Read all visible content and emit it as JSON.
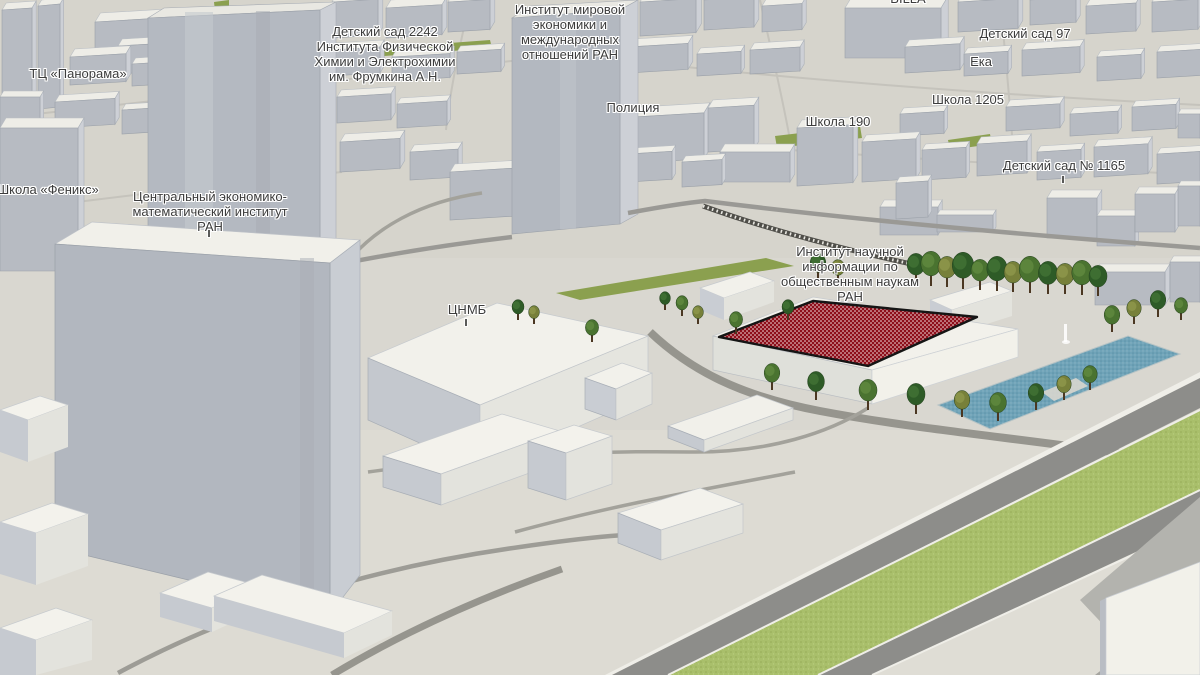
{
  "map": {
    "view": "3d-buildings-perspective",
    "colors": {
      "selection_red": "#8e0e1a",
      "water": "#6fa3b8",
      "grass_median": "#a9bf6b",
      "grass_far": "#8ba04f",
      "label_text": "#3c3c3c"
    },
    "labels": {
      "panorama": "ТЦ «Панорама»",
      "detsky_sad_2242": "Детский сад 2242\nИнститута Физической\nХимии и Электрохимии\nим. Фрумкина А.Н.",
      "imemo": "Институт мировой\nэкономики и\nмеждународных\nотношений РАН",
      "billa": "BILLA",
      "detsky_sad_97": "Детский сад 97",
      "eka": "Ека",
      "shkola_1205": "Школа 1205",
      "shkola_190": "Школа 190",
      "politsiya": "Полиция",
      "detsky_sad_1165": "Детский сад № 1165",
      "shkola_feniks": "Школа «Феникс»",
      "tsemi": "Центральный экономико-\nматематический институт\nРАН",
      "tsnmb": "ЦНМБ",
      "inion": "Институт научной\nинформации по\nобщественным наукам\nРАН"
    }
  }
}
